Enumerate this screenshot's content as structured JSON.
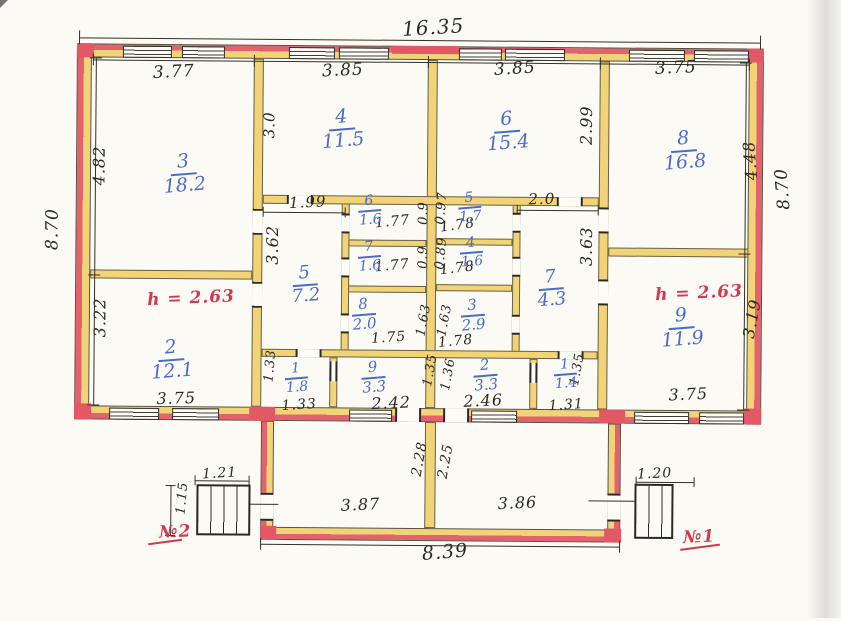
{
  "plan_title": "floor plan",
  "overall_dimensions": {
    "top_width": "16.35",
    "left_height": "8.70",
    "right_height": "8.70",
    "veranda_width": "8.39"
  },
  "ceiling_heights": [
    {
      "text": "h = 2.63",
      "x": 191,
      "y": 300
    },
    {
      "text": "h = 2.63",
      "x": 699,
      "y": 291
    }
  ],
  "entrances": [
    {
      "text": "№2",
      "x": 177,
      "y": 534
    },
    {
      "text": "№1",
      "x": 701,
      "y": 535
    }
  ],
  "rooms": [
    {
      "num": "3",
      "area": "18.2",
      "x": 183,
      "y": 176,
      "fs": 19
    },
    {
      "num": "4",
      "area": "11.5",
      "x": 341,
      "y": 130,
      "fs": 19
    },
    {
      "num": "6",
      "area": "15.4",
      "x": 506,
      "y": 131,
      "fs": 19
    },
    {
      "num": "8",
      "area": "16.8",
      "x": 683,
      "y": 149,
      "fs": 19
    },
    {
      "num": "2",
      "area": "12.1",
      "x": 172,
      "y": 362,
      "fs": 19
    },
    {
      "num": "5",
      "area": "7.2",
      "x": 305,
      "y": 286,
      "fs": 18
    },
    {
      "num": "7",
      "area": "4.3",
      "x": 551,
      "y": 288,
      "fs": 18
    },
    {
      "num": "9",
      "area": "11.9",
      "x": 682,
      "y": 326,
      "fs": 19
    },
    {
      "num": "6",
      "area": "1.6",
      "x": 369,
      "y": 211,
      "fs": 14
    },
    {
      "num": "7",
      "area": "1.6",
      "x": 369,
      "y": 257,
      "fs": 14
    },
    {
      "num": "8",
      "area": "2.0",
      "x": 364,
      "y": 315,
      "fs": 15
    },
    {
      "num": "5",
      "area": "1.7",
      "x": 469,
      "y": 207,
      "fs": 14
    },
    {
      "num": "4",
      "area": "1.6",
      "x": 471,
      "y": 252,
      "fs": 14
    },
    {
      "num": "3",
      "area": "2.9",
      "x": 473,
      "y": 315,
      "fs": 15
    },
    {
      "num": "1",
      "area": "1.8",
      "x": 297,
      "y": 379,
      "fs": 14
    },
    {
      "num": "9",
      "area": "3.3",
      "x": 374,
      "y": 378,
      "fs": 15
    },
    {
      "num": "2",
      "area": "3.3",
      "x": 486,
      "y": 375,
      "fs": 15
    },
    {
      "num": "1",
      "area": "1.4",
      "x": 566,
      "y": 373,
      "fs": 14
    }
  ],
  "dimensions": [
    {
      "text": "16.35",
      "x": 431,
      "y": 27,
      "rot": -4,
      "fs": 20
    },
    {
      "text": "3.77",
      "x": 172,
      "y": 74,
      "rot": -3,
      "fs": 17
    },
    {
      "text": "3.85",
      "x": 341,
      "y": 71,
      "rot": -3,
      "fs": 17
    },
    {
      "text": "3.85",
      "x": 513,
      "y": 68,
      "rot": -4,
      "fs": 17
    },
    {
      "text": "3.75",
      "x": 674,
      "y": 66,
      "rot": -3,
      "fs": 17
    },
    {
      "text": "8.70",
      "x": 52,
      "y": 232,
      "rot": -90,
      "fs": 17
    },
    {
      "text": "4.82",
      "x": 98,
      "y": 168,
      "rot": -90,
      "fs": 16
    },
    {
      "text": "3.22",
      "x": 100,
      "y": 320,
      "rot": -90,
      "fs": 16
    },
    {
      "text": "8.70",
      "x": 782,
      "y": 186,
      "rot": -95,
      "fs": 17
    },
    {
      "text": "4.48",
      "x": 749,
      "y": 158,
      "rot": -95,
      "fs": 16
    },
    {
      "text": "3.19",
      "x": 752,
      "y": 316,
      "rot": -80,
      "fs": 16
    },
    {
      "text": "3.0",
      "x": 268,
      "y": 126,
      "rot": -90,
      "fs": 15
    },
    {
      "text": "2.99",
      "x": 585,
      "y": 124,
      "rot": -90,
      "fs": 16
    },
    {
      "text": "1.99",
      "x": 307,
      "y": 203,
      "rot": -3,
      "fs": 15
    },
    {
      "text": "2.0",
      "x": 541,
      "y": 198,
      "rot": -2,
      "fs": 15
    },
    {
      "text": "3.62",
      "x": 272,
      "y": 246,
      "rot": -90,
      "fs": 16
    },
    {
      "text": "3.63",
      "x": 586,
      "y": 245,
      "rot": -90,
      "fs": 16
    },
    {
      "text": "1.77",
      "x": 392,
      "y": 222,
      "rot": -6,
      "fs": 14
    },
    {
      "text": "0.9",
      "x": 423,
      "y": 213,
      "rot": -90,
      "fs": 13
    },
    {
      "text": "0.97",
      "x": 441,
      "y": 208,
      "rot": -85,
      "fs": 13
    },
    {
      "text": "1.78",
      "x": 457,
      "y": 225,
      "rot": -8,
      "fs": 14
    },
    {
      "text": "1.77",
      "x": 392,
      "y": 266,
      "rot": -6,
      "fs": 14
    },
    {
      "text": "0.9",
      "x": 423,
      "y": 257,
      "rot": -90,
      "fs": 13
    },
    {
      "text": "0.89",
      "x": 441,
      "y": 253,
      "rot": -85,
      "fs": 13
    },
    {
      "text": "1.78",
      "x": 457,
      "y": 268,
      "rot": -7,
      "fs": 14
    },
    {
      "text": "1.75",
      "x": 389,
      "y": 338,
      "rot": -4,
      "fs": 14
    },
    {
      "text": "1.63",
      "x": 424,
      "y": 320,
      "rot": -80,
      "fs": 13
    },
    {
      "text": "1.63",
      "x": 445,
      "y": 320,
      "rot": -80,
      "fs": 13
    },
    {
      "text": "1.78",
      "x": 456,
      "y": 341,
      "rot": -6,
      "fs": 14
    },
    {
      "text": "3.75",
      "x": 177,
      "y": 400,
      "rot": -2,
      "fs": 16
    },
    {
      "text": "3.75",
      "x": 689,
      "y": 392,
      "rot": -3,
      "fs": 16
    },
    {
      "text": "1.33",
      "x": 271,
      "y": 367,
      "rot": -85,
      "fs": 13
    },
    {
      "text": "1.33",
      "x": 300,
      "y": 406,
      "rot": -4,
      "fs": 14
    },
    {
      "text": "2.42",
      "x": 392,
      "y": 403,
      "rot": -3,
      "fs": 16
    },
    {
      "text": "1.35",
      "x": 431,
      "y": 370,
      "rot": -80,
      "fs": 13
    },
    {
      "text": "1.36",
      "x": 449,
      "y": 374,
      "rot": -80,
      "fs": 13
    },
    {
      "text": "2.46",
      "x": 484,
      "y": 400,
      "rot": -3,
      "fs": 16
    },
    {
      "text": "1.31",
      "x": 567,
      "y": 404,
      "rot": -4,
      "fs": 14
    },
    {
      "text": "1.35",
      "x": 578,
      "y": 368,
      "rot": -80,
      "fs": 13
    },
    {
      "text": "2.28",
      "x": 421,
      "y": 459,
      "rot": -80,
      "fs": 14
    },
    {
      "text": "2.25",
      "x": 447,
      "y": 461,
      "rot": -80,
      "fs": 14
    },
    {
      "text": "3.87",
      "x": 362,
      "y": 505,
      "rot": -3,
      "fs": 16
    },
    {
      "text": "3.86",
      "x": 519,
      "y": 502,
      "rot": -3,
      "fs": 16
    },
    {
      "text": "8.39",
      "x": 447,
      "y": 552,
      "rot": -5,
      "fs": 19
    },
    {
      "text": "1.21",
      "x": 221,
      "y": 475,
      "rot": -4,
      "fs": 14
    },
    {
      "text": "1.15",
      "x": 184,
      "y": 500,
      "rot": -85,
      "fs": 13
    },
    {
      "text": "1.20",
      "x": 656,
      "y": 472,
      "rot": -3,
      "fs": 14
    }
  ]
}
